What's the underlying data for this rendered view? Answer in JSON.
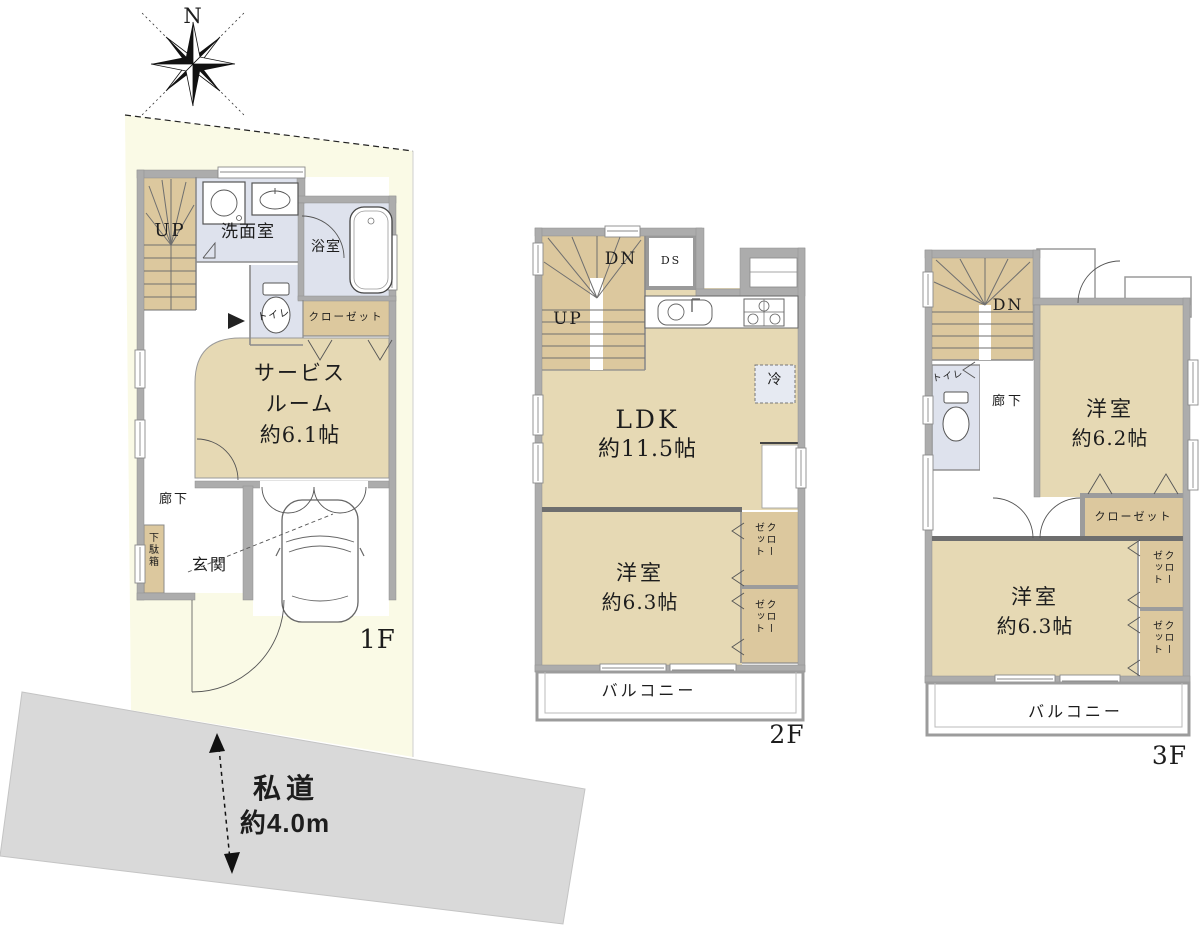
{
  "compass": {
    "north_label": "N"
  },
  "site": {
    "road_name": "私道",
    "road_width": "約4.0m"
  },
  "floor1": {
    "label": "1F",
    "stairs_up": "UP",
    "washroom": "洗面室",
    "bathroom": "浴室",
    "toilet": "トイレ",
    "closet": "クローゼット",
    "service_room_l1": "サービス",
    "service_room_l2": "ルーム",
    "service_room_l3": "約6.1帖",
    "hallway": "廊下",
    "shoe_cabinet": "下駄箱",
    "entrance": "玄関"
  },
  "floor2": {
    "label": "2F",
    "stairs_dn": "DN",
    "stairs_up": "UP",
    "duct_space": "DS",
    "ldk_l1": "LDK",
    "ldk_l2": "約11.5帖",
    "refrigerator": "冷",
    "room_l1": "洋室",
    "room_l2": "約6.3帖",
    "closet_top": "クローゼット",
    "closet_bottom": "クローゼット",
    "balcony": "バルコニー"
  },
  "floor3": {
    "label": "3F",
    "stairs_dn": "DN",
    "toilet": "トイレ",
    "hallway": "廊下",
    "room_a_l1": "洋室",
    "room_a_l2": "約6.2帖",
    "closet_a": "クローゼット",
    "room_b_l1": "洋室",
    "room_b_l2": "約6.3帖",
    "closet_b": "クローゼット",
    "closet_c": "クローゼット",
    "balcony": "バルコニー"
  },
  "colors": {
    "lot": "#FAFAE6",
    "road": "#D9D9D9",
    "wall": "#ACACAC",
    "room": "#E6D9B4",
    "stairs": "#DCC89E",
    "wet": "#DEE2ED"
  }
}
